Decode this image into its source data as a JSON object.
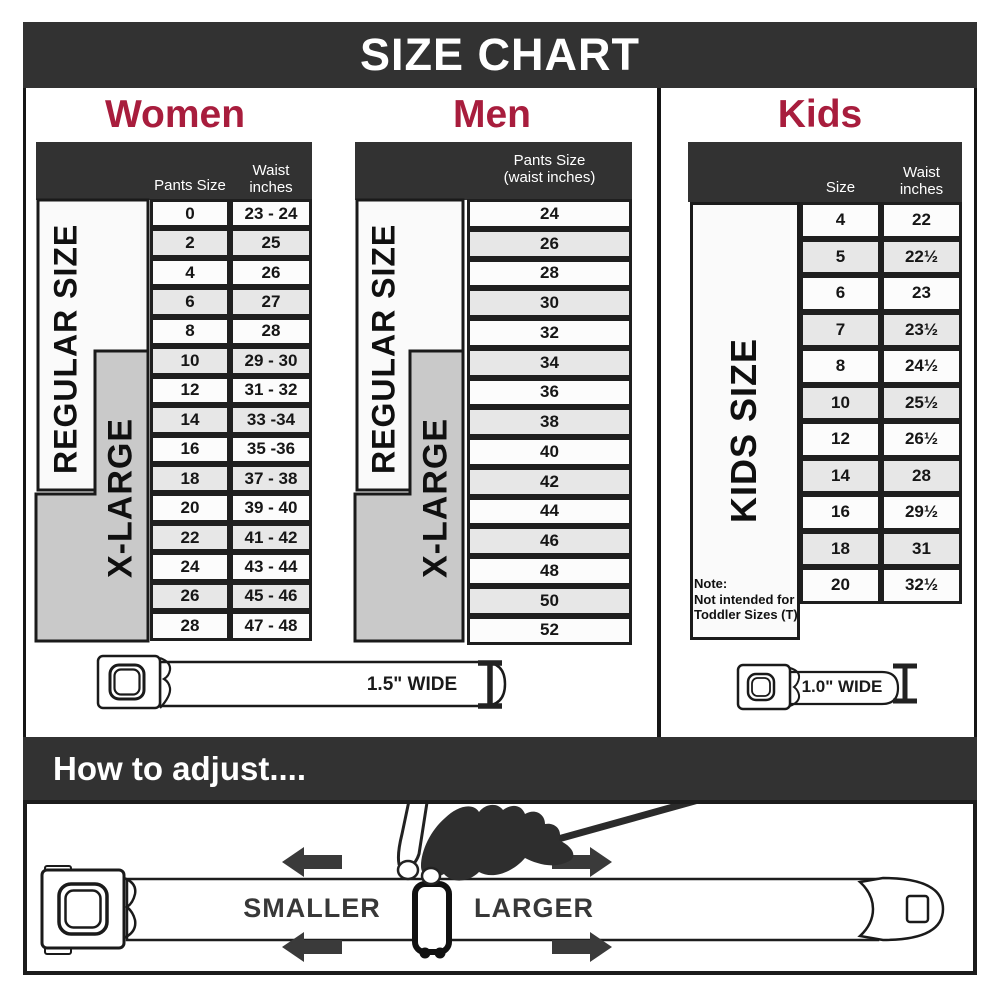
{
  "title": "SIZE CHART",
  "colors": {
    "accent_red": "#A81D3D",
    "bar_dark": "#323232",
    "row_shade": "#E7E7E7",
    "xlarge_gray": "#C9C9C9"
  },
  "sections": {
    "women": {
      "heading": "Women",
      "col_headers": {
        "pants": "Pants Size",
        "waist_line1": "Waist",
        "waist_line2": "inches"
      },
      "regular_label": "REGULAR SIZE",
      "xlarge_label": "X-LARGE",
      "rows": [
        {
          "size": "0",
          "waist": "23 - 24"
        },
        {
          "size": "2",
          "waist": "25"
        },
        {
          "size": "4",
          "waist": "26"
        },
        {
          "size": "6",
          "waist": "27"
        },
        {
          "size": "8",
          "waist": "28"
        },
        {
          "size": "10",
          "waist": "29 - 30"
        },
        {
          "size": "12",
          "waist": "31 - 32"
        },
        {
          "size": "14",
          "waist": "33 -34"
        },
        {
          "size": "16",
          "waist": "35 -36"
        },
        {
          "size": "18",
          "waist": "37 - 38"
        },
        {
          "size": "20",
          "waist": "39 - 40"
        },
        {
          "size": "22",
          "waist": "41 - 42"
        },
        {
          "size": "24",
          "waist": "43 - 44"
        },
        {
          "size": "26",
          "waist": "45 - 46"
        },
        {
          "size": "28",
          "waist": "47 - 48"
        }
      ]
    },
    "men": {
      "heading": "Men",
      "col_header_line1": "Pants Size",
      "col_header_line2": "(waist inches)",
      "regular_label": "REGULAR SIZE",
      "xlarge_label": "X-LARGE",
      "rows": [
        "24",
        "26",
        "28",
        "30",
        "32",
        "34",
        "36",
        "38",
        "40",
        "42",
        "44",
        "46",
        "48",
        "50",
        "52"
      ]
    },
    "kids": {
      "heading": "Kids",
      "col_headers": {
        "size": "Size",
        "waist_line1": "Waist",
        "waist_line2": "inches"
      },
      "side_label": "KIDS SIZE",
      "note": {
        "line1": "Note:",
        "line2": "Not intended for",
        "line3": "Toddler Sizes (T)"
      },
      "rows": [
        {
          "size": "4",
          "waist": "22"
        },
        {
          "size": "5",
          "waist": "22½"
        },
        {
          "size": "6",
          "waist": "23"
        },
        {
          "size": "7",
          "waist": "23½"
        },
        {
          "size": "8",
          "waist": "24½"
        },
        {
          "size": "10",
          "waist": "25½"
        },
        {
          "size": "12",
          "waist": "26½"
        },
        {
          "size": "14",
          "waist": "28"
        },
        {
          "size": "16",
          "waist": "29½"
        },
        {
          "size": "18",
          "waist": "31"
        },
        {
          "size": "20",
          "waist": "32½"
        }
      ]
    }
  },
  "belts": {
    "adult_width_label": "1.5\" WIDE",
    "kids_width_label": "1.0\" WIDE"
  },
  "adjust": {
    "heading": "How to adjust....",
    "smaller_label": "SMALLER",
    "larger_label": "LARGER"
  }
}
